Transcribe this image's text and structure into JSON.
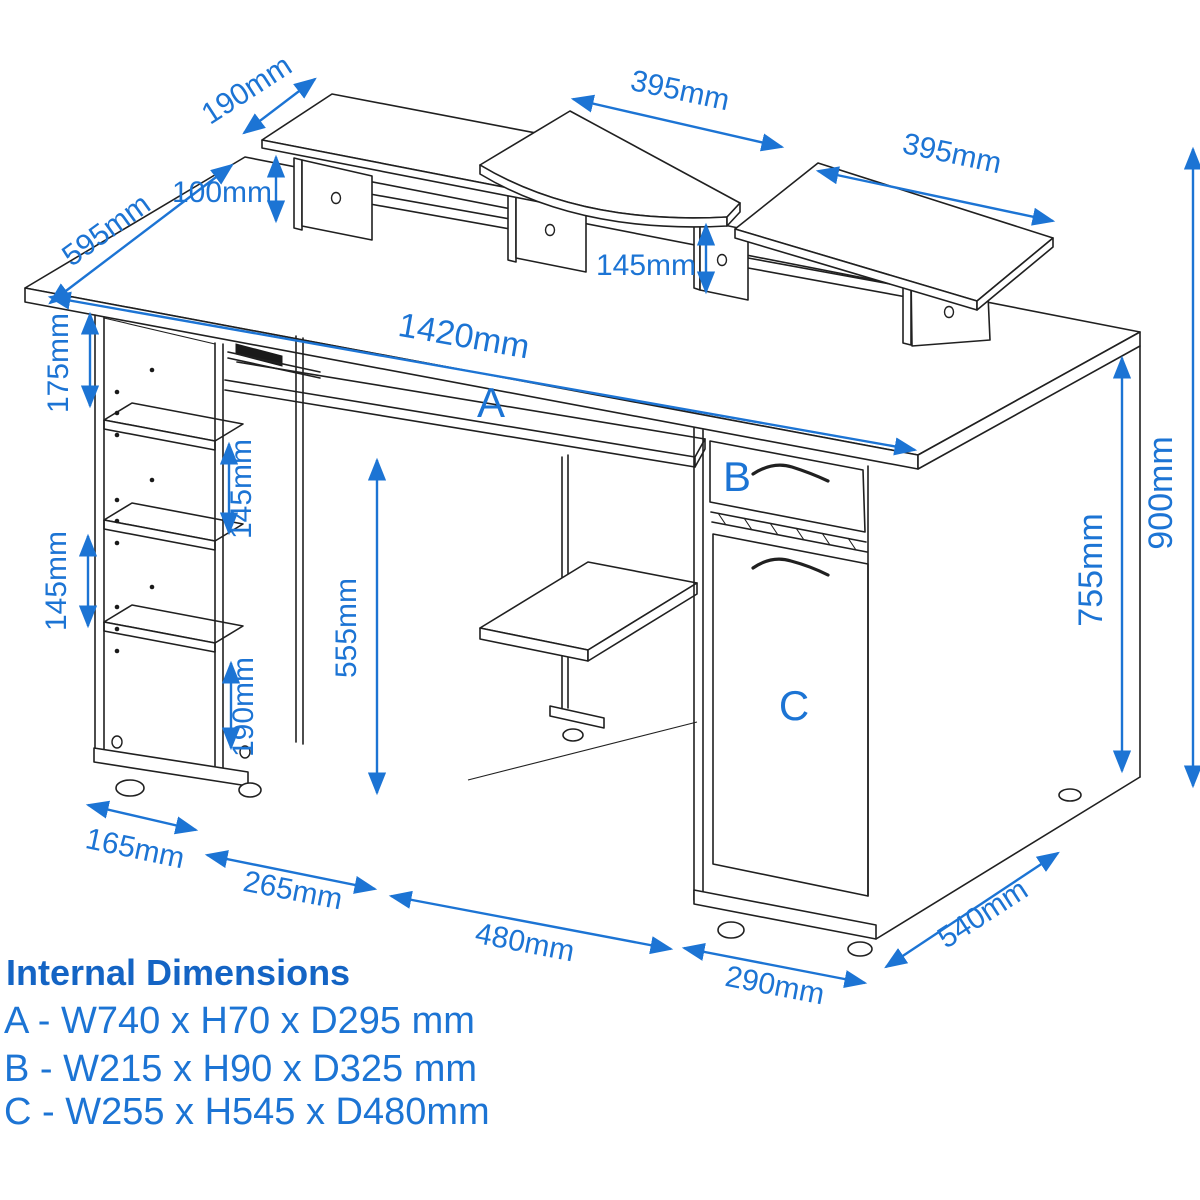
{
  "colors": {
    "accent_blue": "#1c74d4",
    "heading_blue": "#1464c4",
    "line_color": "#202020",
    "background": "#ffffff"
  },
  "dimensions": {
    "top_shelf_depth": "190mm",
    "desk_depth": "595mm",
    "left_riser_height": "100mm",
    "monitor_shelf_width": "395mm",
    "right_shelf_width": "395mm",
    "shelf_riser_height": "145mm",
    "desk_width": "1420mm",
    "top_gap": "175mm",
    "left_shelf_gap": "145mm",
    "inner_gap": "145mm",
    "cpu_bay_height": "555mm",
    "bottom_gap": "190mm",
    "under_desk_height": "755mm",
    "total_height": "900mm",
    "left_bay_depth": "165mm",
    "left_bay_width": "265mm",
    "center_bay_width": "480mm",
    "pedestal_width": "290mm",
    "base_depth": "540mm"
  },
  "zones": {
    "a": "A",
    "b": "B",
    "c": "C"
  },
  "internal_dimensions": {
    "heading": "Internal Dimensions",
    "rows": [
      "A - W740 x H70 x D295 mm",
      "B - W215 x H90 x D325 mm",
      "C - W255 x H545 x D480mm"
    ]
  }
}
